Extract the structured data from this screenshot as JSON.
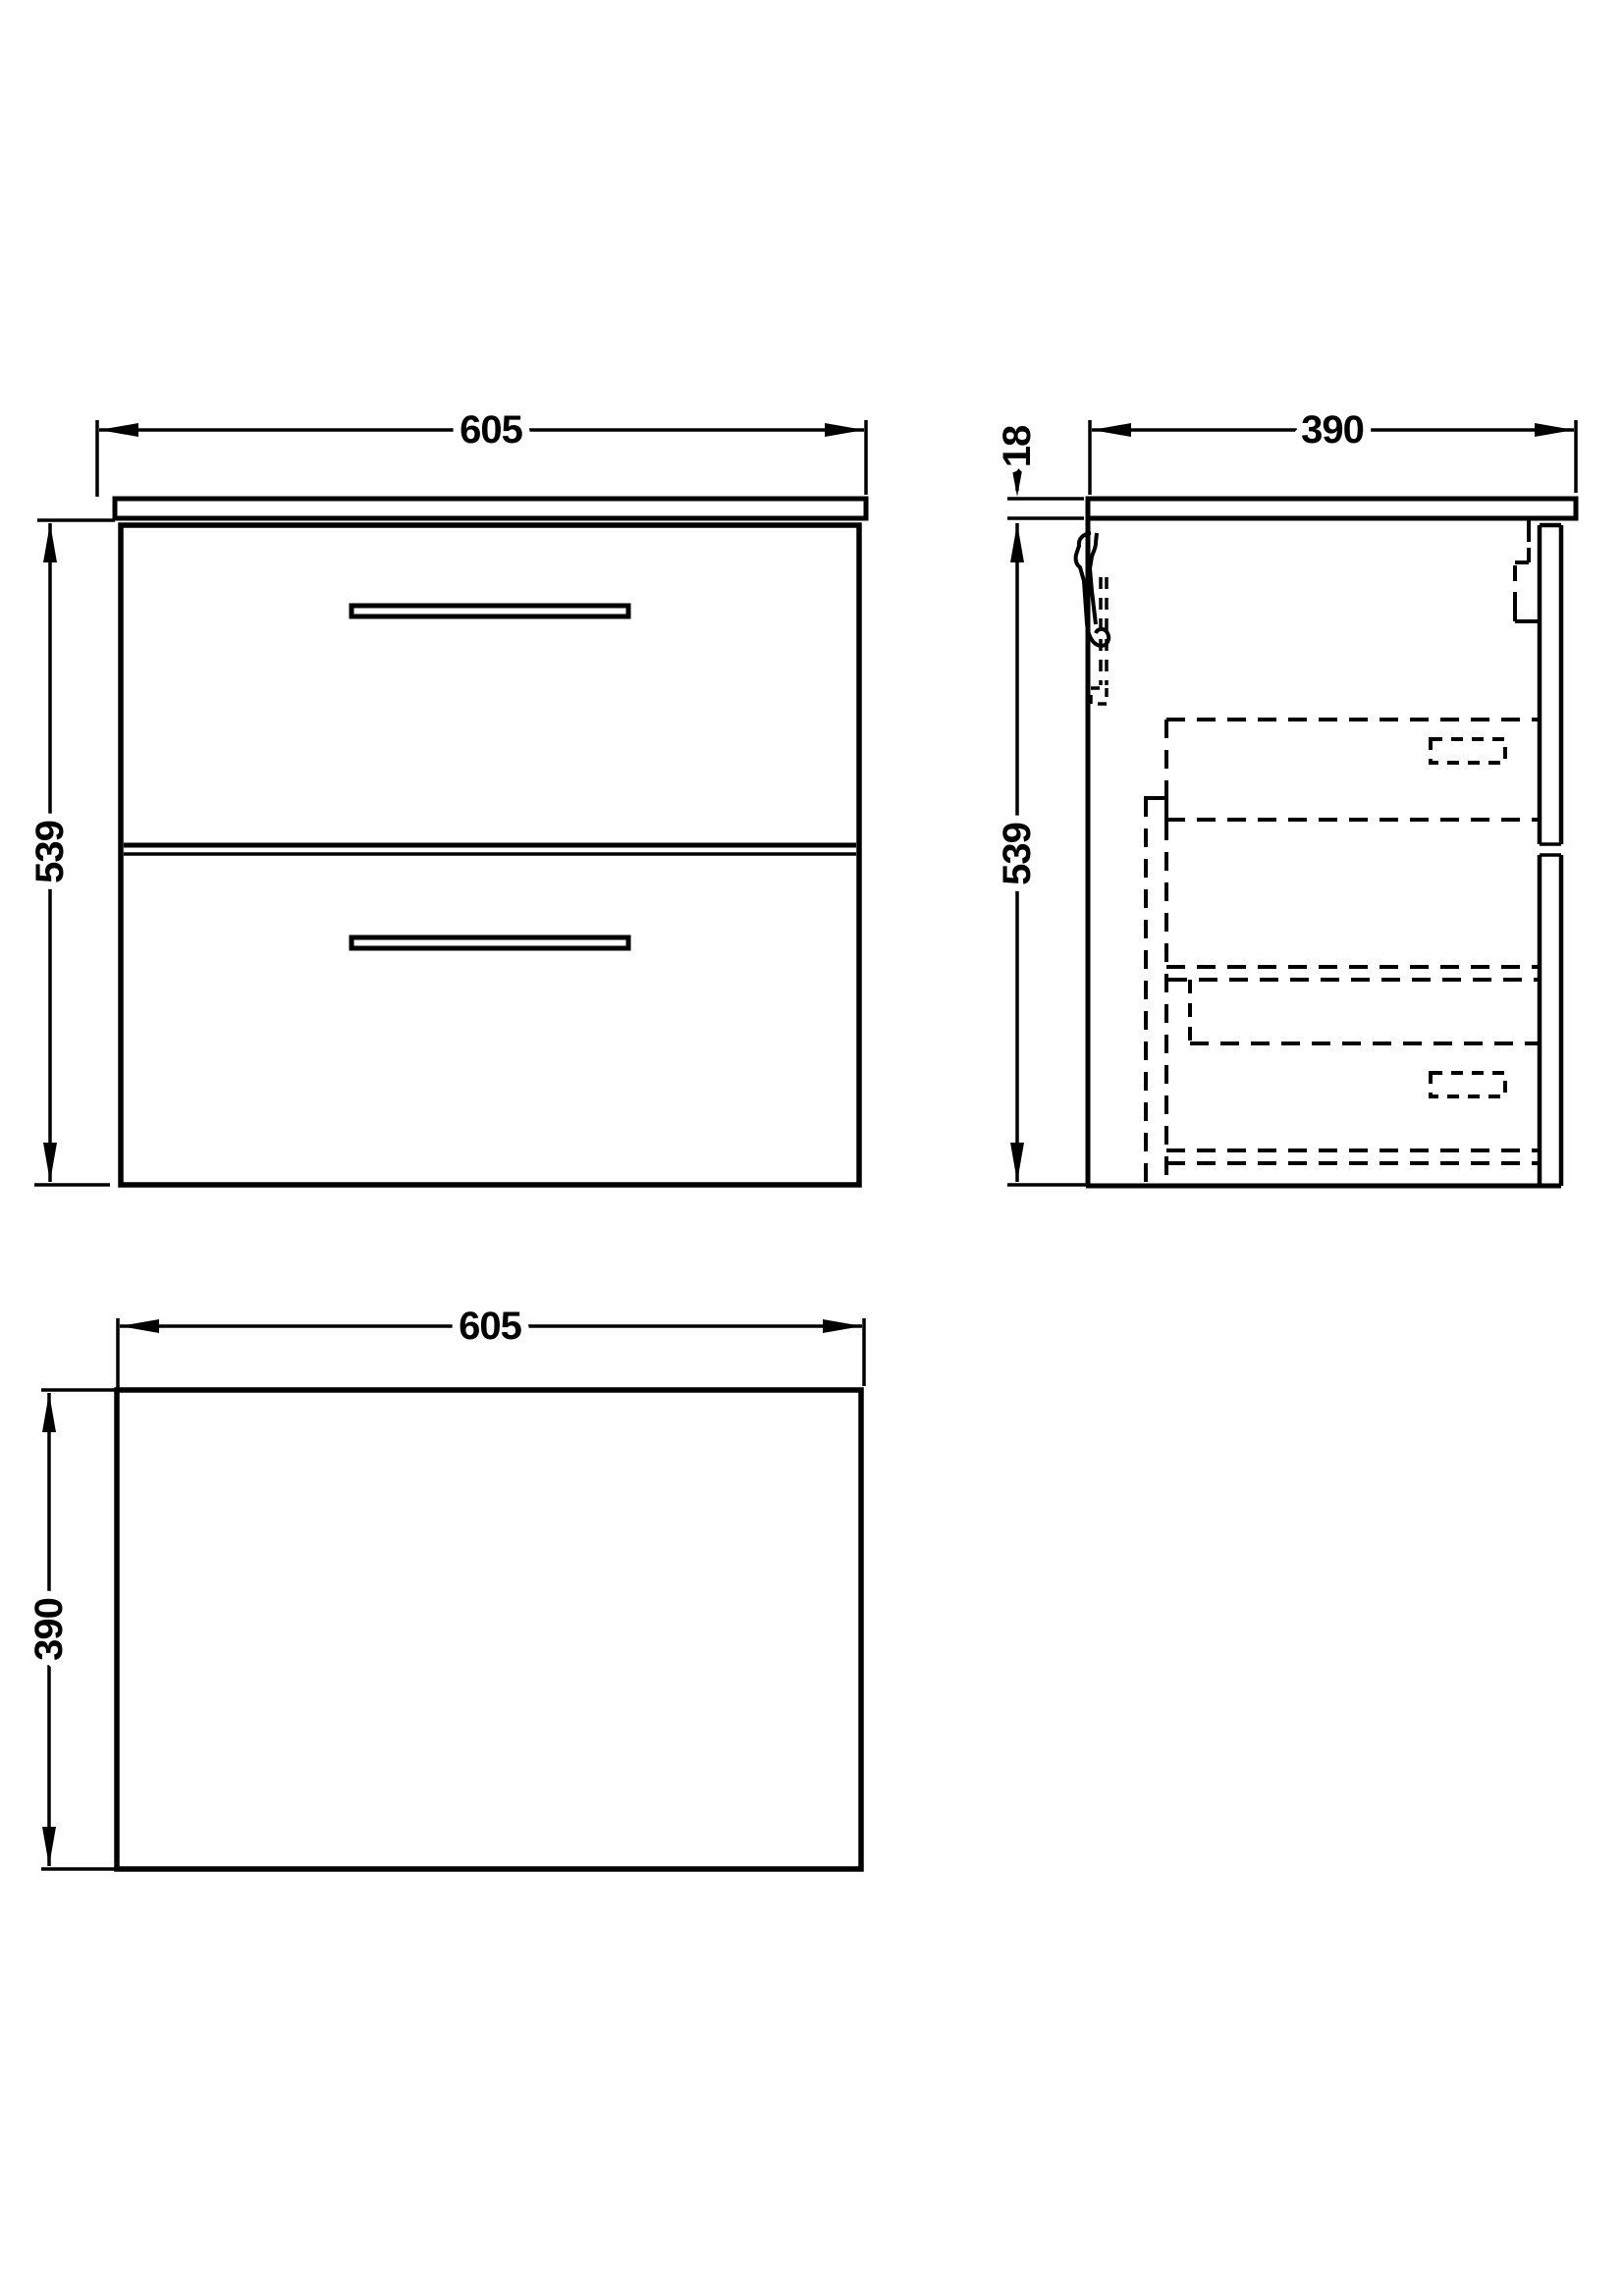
{
  "colors": {
    "line": "#000000",
    "background": "#ffffff"
  },
  "views": {
    "front": {
      "width_label": "605",
      "height_label": "539"
    },
    "side": {
      "depth_label": "390",
      "height_label": "539",
      "worktop_thickness_label": "18"
    },
    "plan": {
      "width_label": "605",
      "depth_label": "390"
    }
  }
}
